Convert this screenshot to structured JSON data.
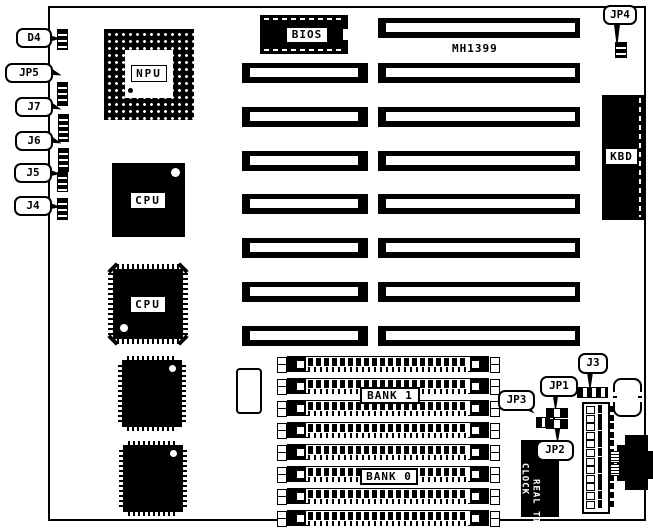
{
  "board": {
    "model": "MH1399"
  },
  "callouts": {
    "left": [
      {
        "label": "D4"
      },
      {
        "label": "JP5"
      },
      {
        "label": "J7"
      },
      {
        "label": "J6"
      },
      {
        "label": "J5"
      },
      {
        "label": "J4"
      }
    ],
    "jp4": "JP4",
    "jp3": "JP3",
    "jp1": "JP1",
    "jp2": "JP2",
    "j3": "J3"
  },
  "chips": {
    "bios": "BIOS",
    "npu": "NPU",
    "cpu_upper": "CPU",
    "cpu_lower": "CPU",
    "kbd": "KBD"
  },
  "memory": {
    "bank1": "BANK 1",
    "bank0": "BANK 0"
  },
  "rtc": {
    "line1": "REAL TIME",
    "line2": "CLOCK"
  },
  "colors": {
    "ink": "#000000",
    "paper": "#ffffff"
  }
}
